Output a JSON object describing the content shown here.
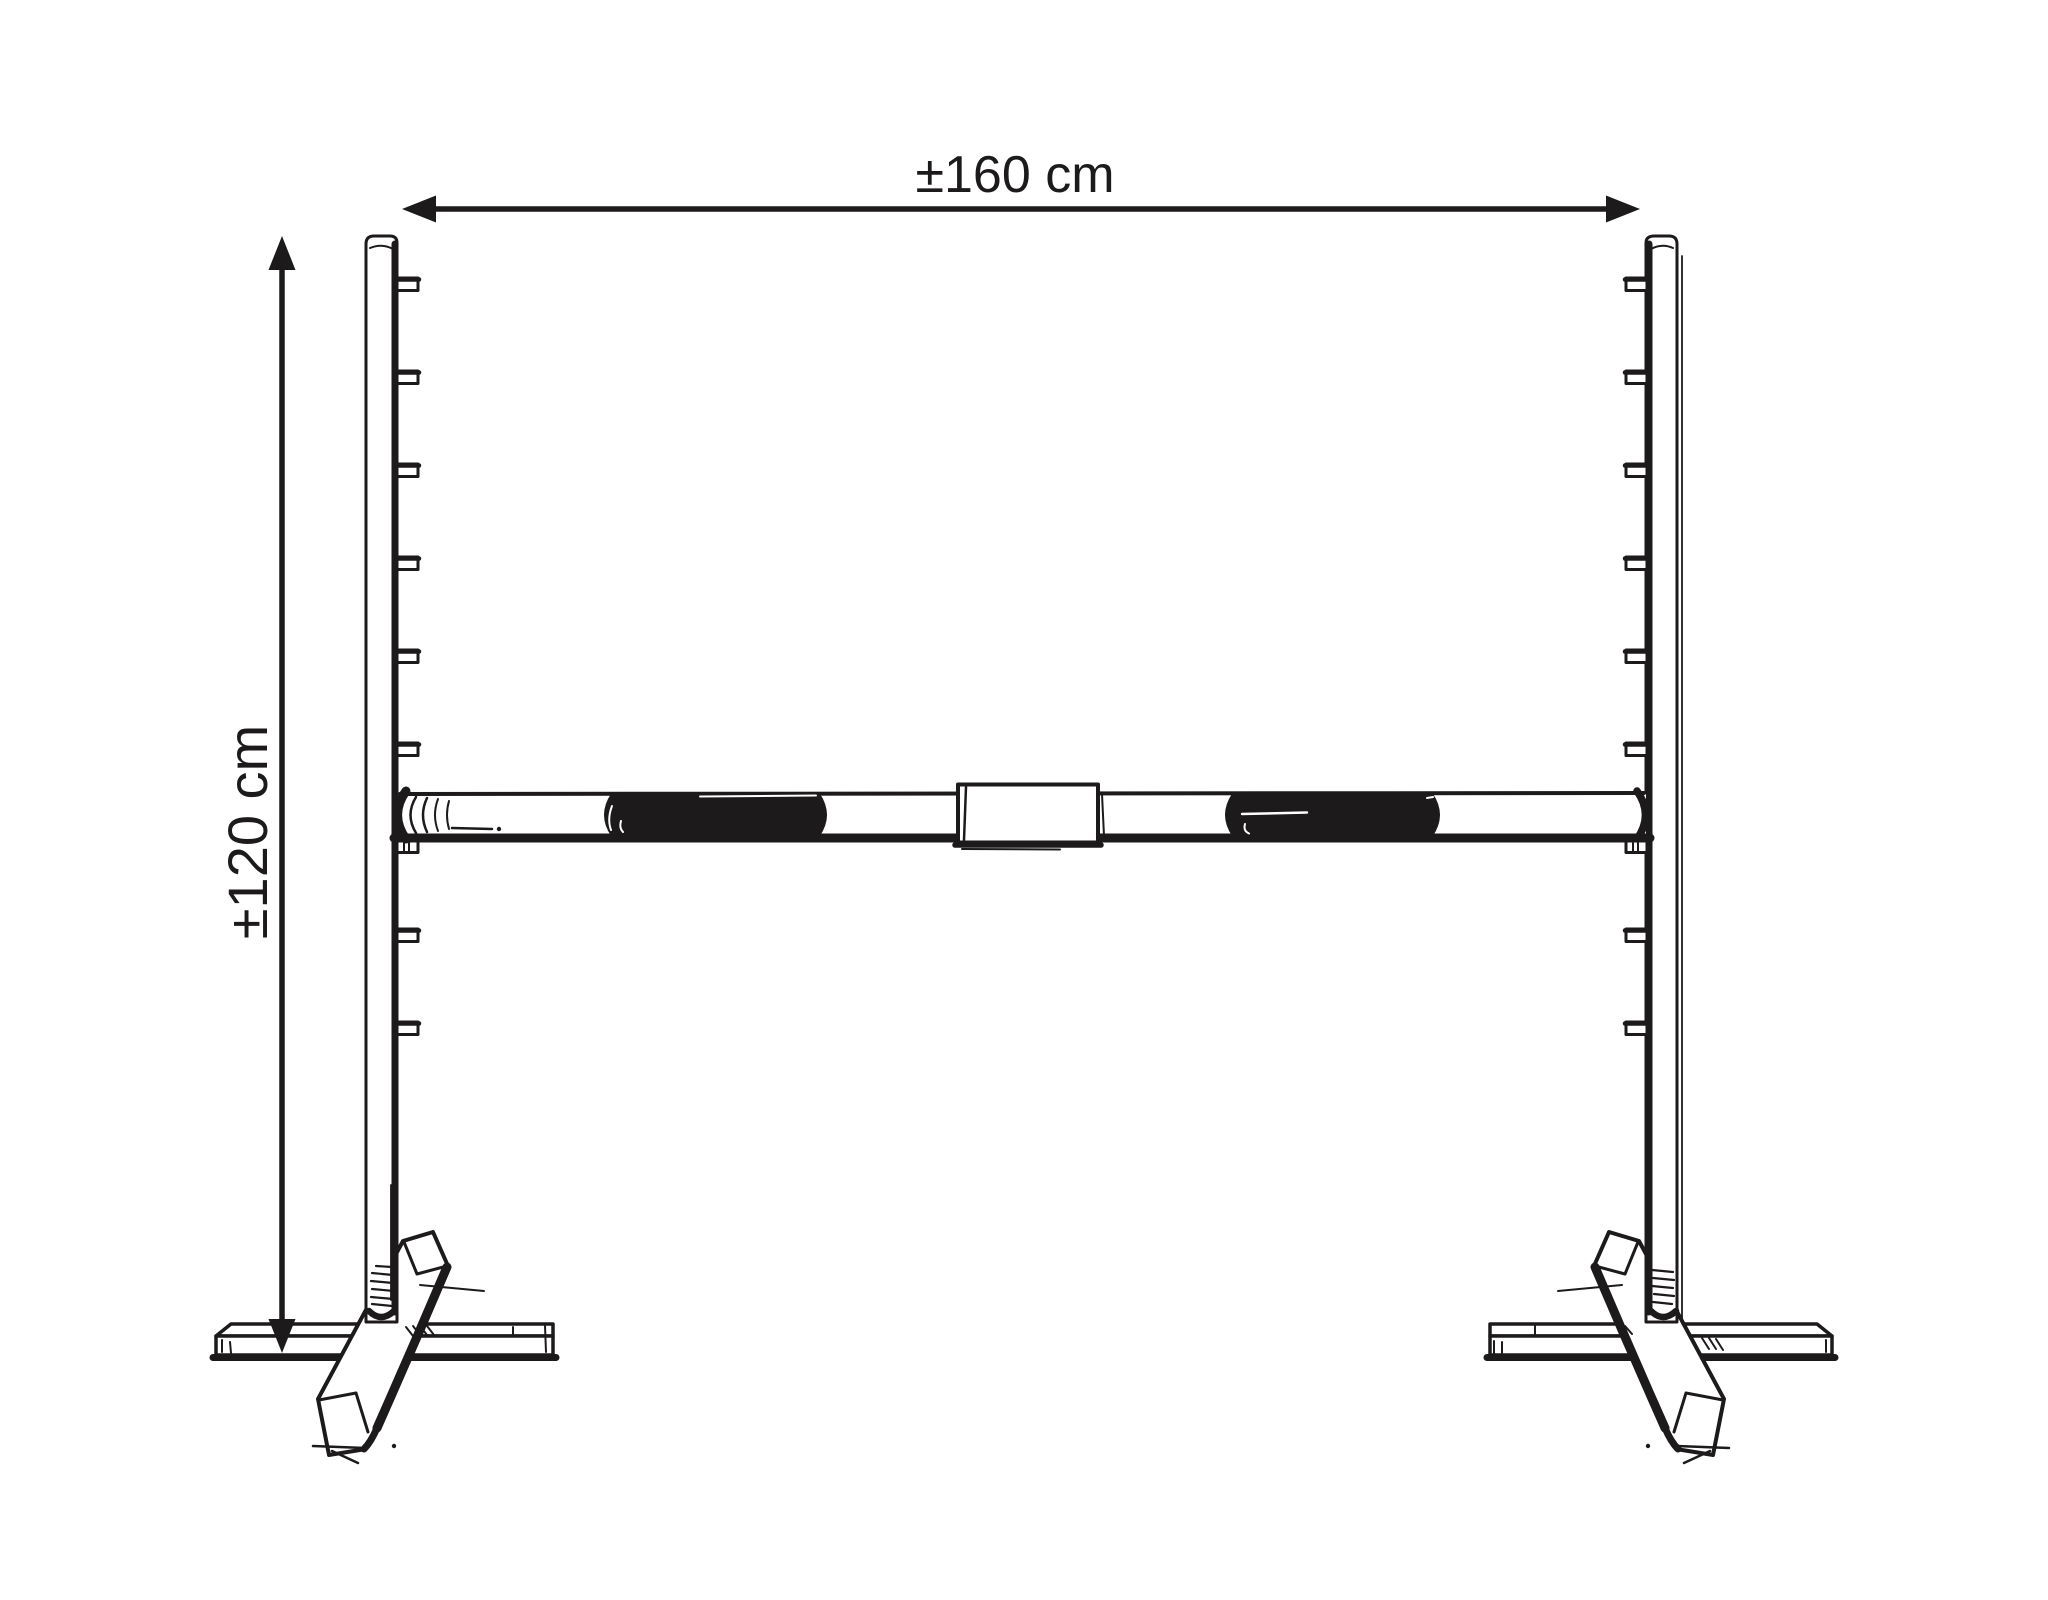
{
  "labels": {
    "width_dimension": "±160 cm",
    "height_dimension": "±120 cm"
  },
  "colors": {
    "ink": "#1d1a1b",
    "paper": "#ffffff"
  }
}
